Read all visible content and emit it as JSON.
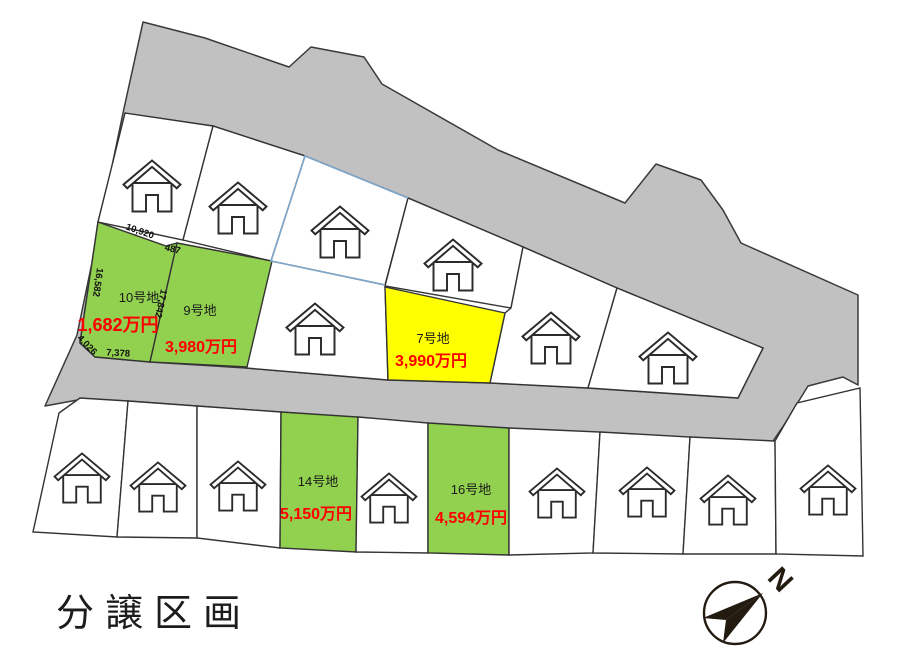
{
  "page": {
    "title_label": "分譲区画"
  },
  "colors": {
    "road": "#c1c1c1",
    "green": "#92d050",
    "yellow": "#ffff00",
    "price": "#ff0000",
    "blue_boundary": "#7fa8cc"
  },
  "plots": {
    "p10": {
      "name": "10号地",
      "price": "1,682万円"
    },
    "p9": {
      "name": "9号地",
      "price": "3,980万円"
    },
    "p7": {
      "name": "7号地",
      "price": "3,990万円"
    },
    "p14": {
      "name": "14号地",
      "price": "5,150万円"
    },
    "p16": {
      "name": "16号地",
      "price": "4,594万円"
    }
  },
  "dimensions": {
    "top": "10,920",
    "step": "487",
    "left": "16,582",
    "right": "17,842",
    "corner": "4,026",
    "bottom": "7,378"
  },
  "compass": {
    "north_label": "N"
  }
}
